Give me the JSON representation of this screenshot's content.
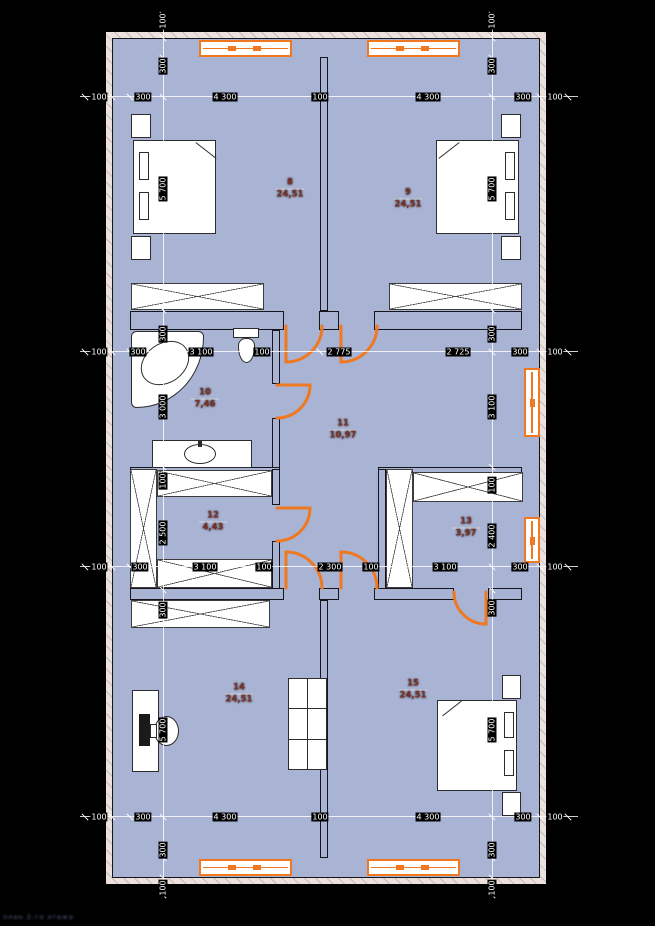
{
  "plan": {
    "title": "second-floor-plan"
  },
  "colors": {
    "wall": "#a9b3d3",
    "window_door_accent": "#f07820",
    "tile_line": "#a6c8ec",
    "finish_band": "#ece1dd",
    "room_label": "#7e3226",
    "background": "#000000"
  },
  "rooms": [
    {
      "name": "bedroom-top-left",
      "num": "8",
      "area": "24,51"
    },
    {
      "name": "bedroom-top-right",
      "num": "9",
      "area": "24,51"
    },
    {
      "name": "bathroom",
      "num": "10",
      "area": "7,46"
    },
    {
      "name": "hall",
      "num": "11",
      "area": "10,97"
    },
    {
      "name": "dressing",
      "num": "12",
      "area": "4,43"
    },
    {
      "name": "storage",
      "num": "13",
      "area": "3,97"
    },
    {
      "name": "bedroom-bottom-left",
      "num": "14",
      "area": "24,51"
    },
    {
      "name": "bedroom-bottom-right",
      "num": "15",
      "area": "24,51"
    }
  ],
  "dims": {
    "top": [
      "100",
      "300",
      "4 300",
      "100",
      "4 300",
      "300",
      "100"
    ],
    "upper_mid": [
      "100",
      "300",
      "3 100",
      "100",
      "2 775",
      "2 725",
      "300",
      "100"
    ],
    "lower_mid": [
      "100",
      "300",
      "3 100",
      "100",
      "2 300",
      "100",
      "3 100",
      "300",
      "100"
    ],
    "bottom": [
      "100",
      "300",
      "4 300",
      "100",
      "4 300",
      "300",
      "100"
    ],
    "left_col": [
      "100",
      "300",
      "5 700",
      "300",
      "3 000",
      "100",
      "2 500",
      "300",
      "5 700",
      "300",
      "100"
    ],
    "right_col": [
      "100",
      "300",
      "5 700",
      "300",
      "3 100",
      "100",
      "2 400",
      "300",
      "5 700",
      "300",
      "100"
    ]
  },
  "watermark": "план 2-го этажа"
}
